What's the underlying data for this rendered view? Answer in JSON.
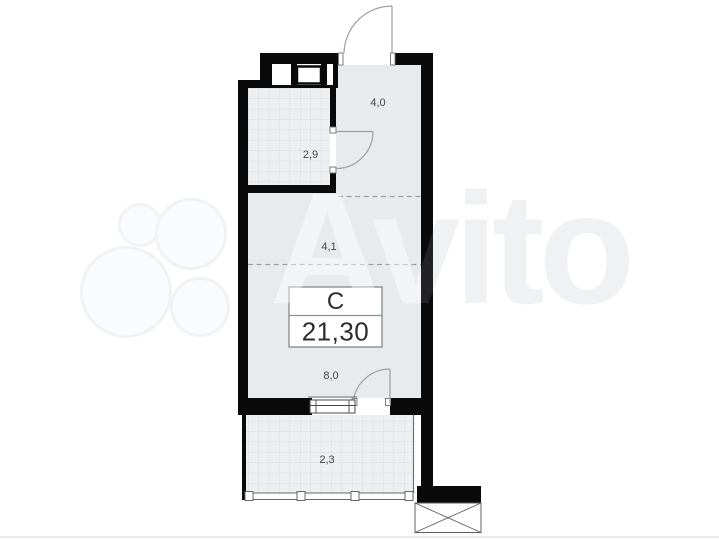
{
  "watermark": {
    "brand_text": "Avito",
    "text_color": "#f0f1f3",
    "logo_circle_color": "#f0f2f4"
  },
  "plan": {
    "rooms": [
      {
        "name": "entry-hall",
        "area_label": "4,0"
      },
      {
        "name": "bathroom",
        "area_label": "2,9"
      },
      {
        "name": "kitchen-zone",
        "area_label": "4,1"
      },
      {
        "name": "living-zone",
        "area_label": "8,0"
      },
      {
        "name": "balcony",
        "area_label": "2,3"
      }
    ],
    "info_box": {
      "type_label": "С",
      "area_value": "21,30"
    },
    "colors": {
      "wall": "#0a0a0b",
      "room_fill": "#e8ebee",
      "hatch_bg": "#edeff0",
      "hatch_line": "#d8dbde",
      "door_stroke": "#9ba1a6",
      "dashed_stroke": "#9aa1a6",
      "label_text": "#43474a",
      "box_border": "#8c9093",
      "box_text": "#2b2d2f",
      "frame_stroke": "#45494d"
    }
  }
}
